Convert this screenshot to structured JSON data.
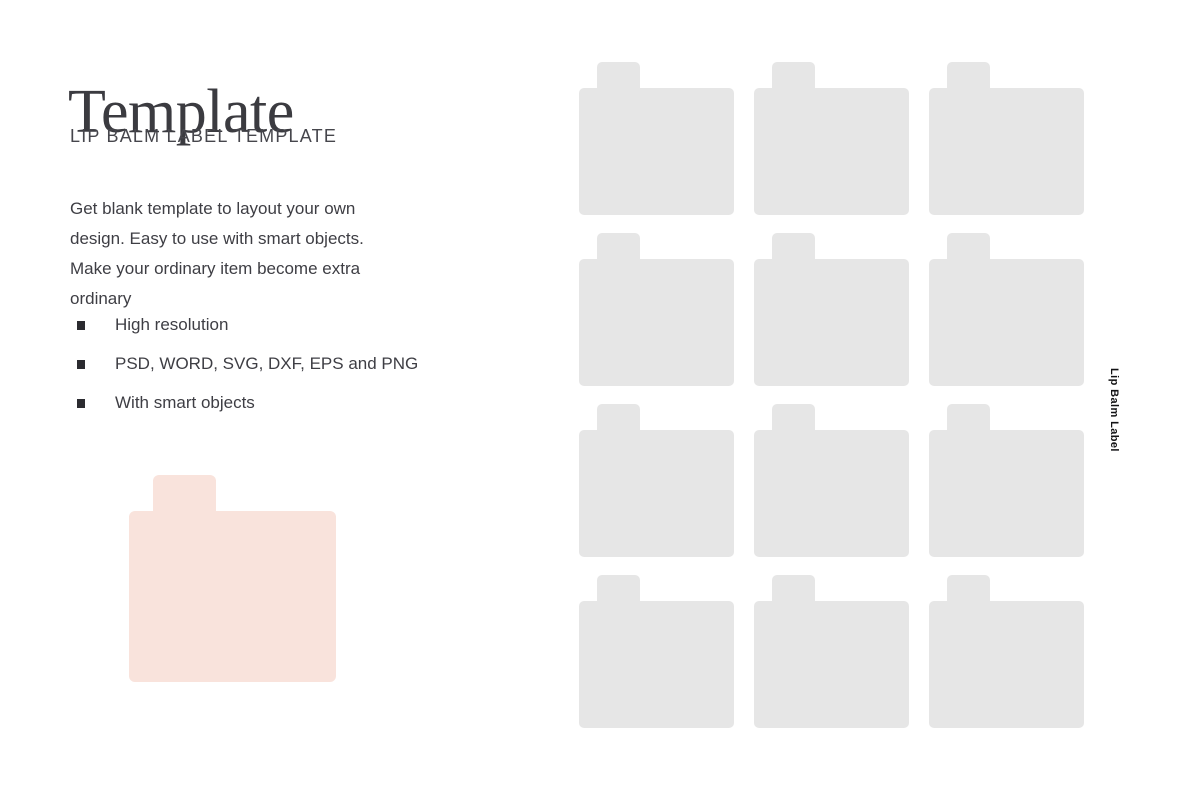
{
  "page": {
    "title": "Template",
    "subtitle": "LIP BALM LABEL TEMPLATE",
    "description": "Get blank template to layout your own design. Easy to use with smart objects. Make your ordinary item become extra ordinary",
    "features": [
      "High resolution",
      "PSD, WORD, SVG, DXF, EPS and PNG",
      "With smart objects"
    ],
    "vertical_label": "Lip Balm Label"
  },
  "colors": {
    "label_gray": "#e6e6e6",
    "label_pink": "#f9e3dc",
    "title_text": "#3b3b40",
    "subtitle_text": "#46464c",
    "body_text": "#3e3e44"
  },
  "grid": {
    "rows": 4,
    "cols": 3
  }
}
